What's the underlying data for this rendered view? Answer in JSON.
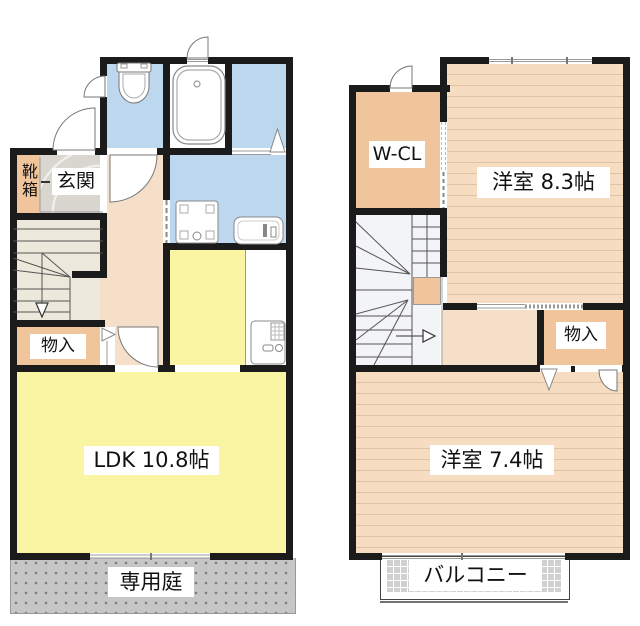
{
  "floor1": {
    "shoe_box_label": "靴箱",
    "entrance_label": "玄関",
    "storage_label": "物入",
    "ldk_label": "LDK 10.8帖",
    "garden_label": "専用庭"
  },
  "floor2": {
    "closet_label": "W-CL",
    "bedroom_main_label": "洋室 8.3帖",
    "storage_label": "物入",
    "bedroom_second_label": "洋室 7.4帖",
    "balcony_label": "バルコニー"
  },
  "colors": {
    "wall": "#1b1b1b",
    "water_area": "#BDD7EE",
    "ldk": "#FAF5A3",
    "storage": "#F1C59C",
    "hallway": "#F6DFC8",
    "bedroom_floor": "#F6DCC1",
    "bedroom_stripe": "#DFC3A6",
    "stairs_1f": "#ECE9DC",
    "stairs_2f": "#F3F4F8",
    "entrance_tile": "#D9D6D0",
    "garden": "#C6C6C6",
    "balcony": "#D0D0D0"
  }
}
